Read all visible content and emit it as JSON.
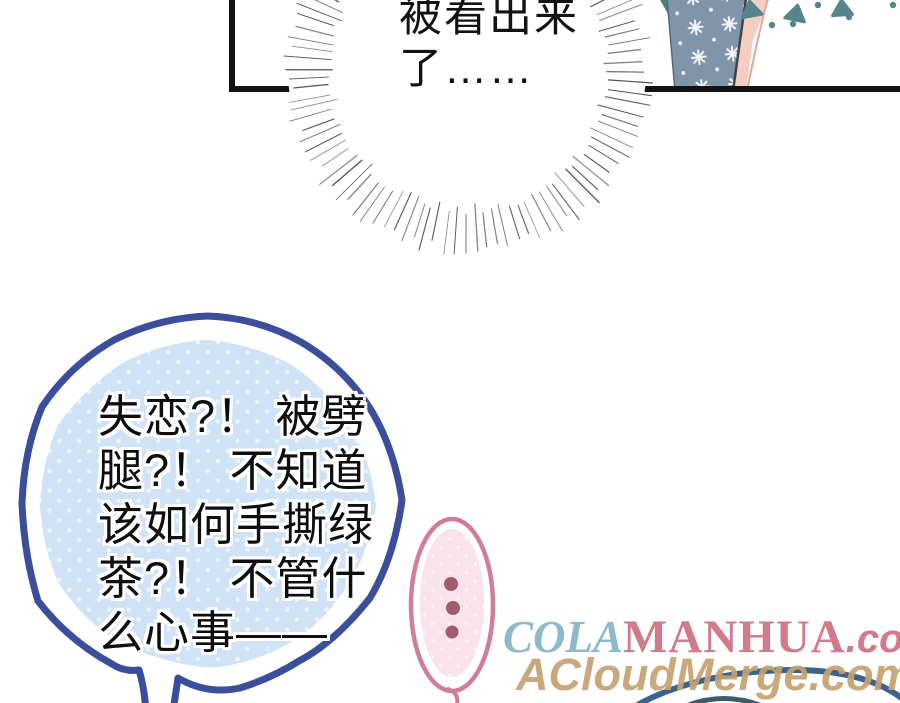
{
  "panel": {
    "dialogue": {
      "line1": "被看出来",
      "line2": "了……"
    }
  },
  "blue_bubble": {
    "lines": [
      "失恋?！ 被劈",
      "腿?！ 不知道",
      "该如何手撕绿",
      "茶?！ 不管什",
      "么心事——"
    ],
    "border_color": "#3a4e9c",
    "fill_color": "#cfe2f6",
    "dot_color": "#eaf4fc"
  },
  "pink_bubble": {
    "border_color": "#cf7e96",
    "fill_color": "#f9e2e9",
    "pattern_dot_color": "#fdf1f4",
    "ellipsis_dot_color": "#9f5c6d",
    "ellipsis_dot_count": 3
  },
  "watermark": {
    "line1": {
      "part_cola": "COLA",
      "cola_color": "#84b4c6",
      "part_manhua": "MANHUA",
      "part_com": ".com",
      "manhua_color": "#ce6f80"
    },
    "line2": {
      "text": "ACloudMerge.com",
      "color": "#c5a271"
    }
  },
  "decor": {
    "panel_border_color": "#111111",
    "burst_line_color": "#4a4a4a",
    "sleeve_color": "#8094aa",
    "sleeve_snow_color": "#f2f5f8",
    "arm_color": "#f5cdc3",
    "collar_color": "#4d7f80",
    "triangle_color": "#54858a",
    "bottom_arc_color": "#3d6191",
    "bottom_inner_arc_color": "#3a5c66",
    "hair_color": "#6e4f3f"
  }
}
